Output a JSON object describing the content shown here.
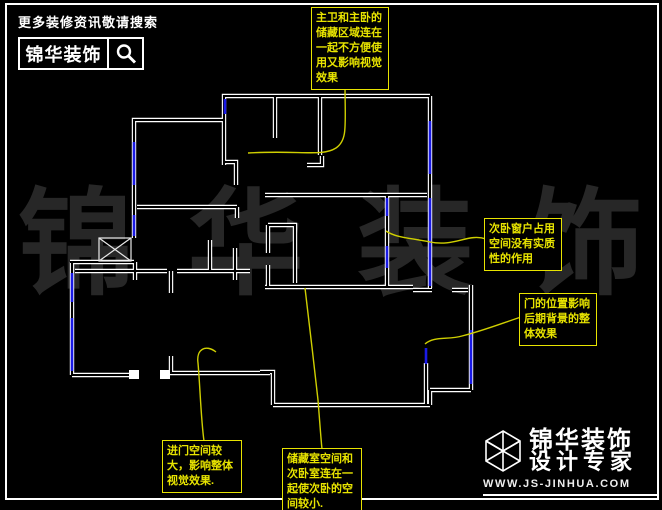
{
  "header": {
    "tagline": "更多装修资讯敬请搜索",
    "brand": "锦华装饰"
  },
  "watermark": {
    "chars": [
      "锦",
      "华",
      "装",
      "饰"
    ]
  },
  "annotations": [
    {
      "id": "master-bath-storage",
      "text": "主卫和主卧的\n储藏区域连在\n一起不方便使\n用又影响视觉\n效果"
    },
    {
      "id": "secondary-bedroom-window",
      "text": "次卧窗户占用\n空间没有实质\n性的作用"
    },
    {
      "id": "door-position",
      "text": "门的位置影响\n后期背景的整\n体效果"
    },
    {
      "id": "entry-space",
      "text": "进门空间较\n大，影响整体\n视觉效果."
    },
    {
      "id": "storage-room",
      "text": "储藏室空间和\n次卧室连在一\n起使次卧的空\n间较小."
    }
  ],
  "footer": {
    "brand": "锦华装饰",
    "subtitle": "设计专家",
    "website": "WWW.JS-JINHUA.COM"
  },
  "colors": {
    "wall": "#ffffff",
    "window": "#1a1ae6",
    "annotation": "#e8e400",
    "leader": "#cfcf00",
    "watermark": "#272727"
  }
}
